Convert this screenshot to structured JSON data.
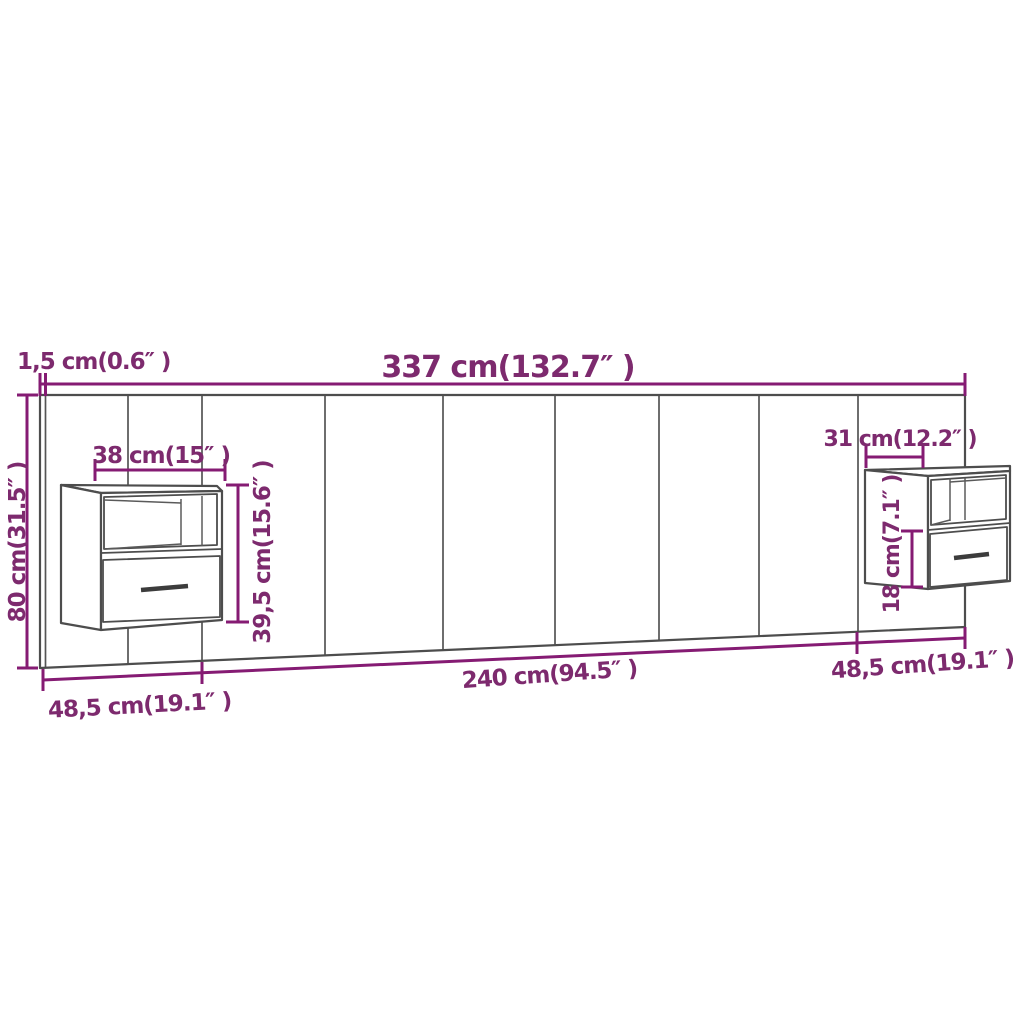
{
  "diagram": {
    "type": "furniture-dimension-diagram",
    "subject": "wall headboard with two floating bedside cabinets",
    "colors": {
      "dimension_accent": "#851B73",
      "label_text": "#7D2A6E",
      "structure_line": "#4d4d4d",
      "background": "#ffffff"
    },
    "labels": {
      "total_width": "337 cm(132.7″ )",
      "side_thickness": "1,5 cm(0.6″ )",
      "total_height": "80 cm(31.5″ )",
      "left_unit_width": "38 cm(15″ )",
      "left_unit_height": "39,5 cm(15.6″ )",
      "right_unit_width": "31 cm(12.2″ )",
      "right_unit_lower_height": "18 cm(7.1″ )",
      "base_left_segment": "48,5 cm(19.1″ )",
      "base_center_segment": "240 cm(94.5″ )",
      "base_right_segment": "48,5 cm(19.1″ )"
    }
  }
}
